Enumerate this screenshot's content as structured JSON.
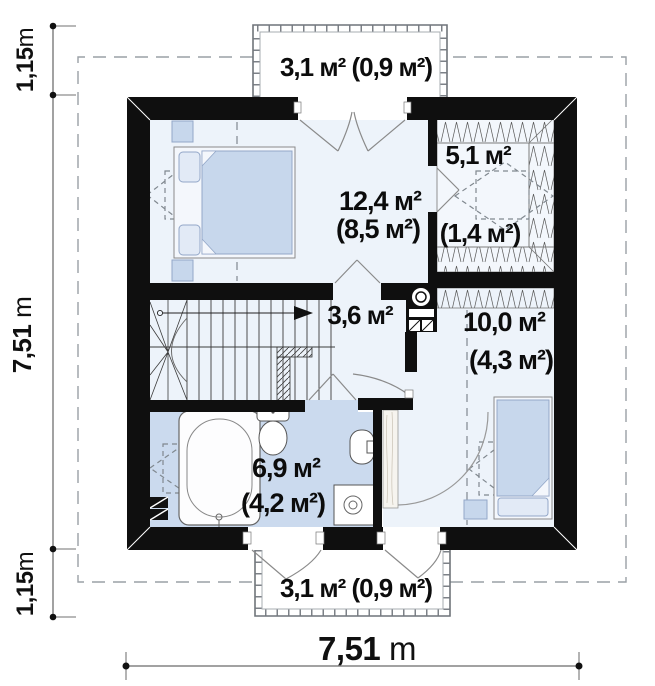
{
  "meta": {
    "type": "floor-plan",
    "level": "attic"
  },
  "colors": {
    "wall": "#0f0f0f",
    "room_floor": "#edf3fa",
    "bath_floor": "#cbdaee",
    "wardrobe_floor": "#f3f7fc",
    "furniture": "#c7d7ec",
    "pillow": "#e2eaf6",
    "dashed": "#9aa0a6"
  },
  "rooms": {
    "bedroom1": {
      "area": "12,4 м²",
      "area_reduced": "(8,5 м²)"
    },
    "wardrobe": {
      "area": "5,1 м²",
      "area_reduced": "(1,4 м²)"
    },
    "hall": {
      "area": "3,6 м²"
    },
    "bedroom2": {
      "area": "10,0 м²",
      "area_reduced": "(4,3 м²)"
    },
    "bathroom": {
      "area": "6,9 м²",
      "area_reduced": "(4,2 м²)"
    },
    "balcony_top": {
      "area": "3,1 м² (0,9 м²)"
    },
    "balcony_bottom": {
      "area": "3,1 м² (0,9 м²)"
    }
  },
  "dimensions": {
    "left_top": {
      "value": "1,15",
      "unit": "m"
    },
    "left_main": {
      "value": "7,51",
      "unit": " m"
    },
    "left_bottom": {
      "value": "1,15",
      "unit": "m"
    },
    "bottom": {
      "value": "7,51",
      "unit": " m"
    }
  }
}
